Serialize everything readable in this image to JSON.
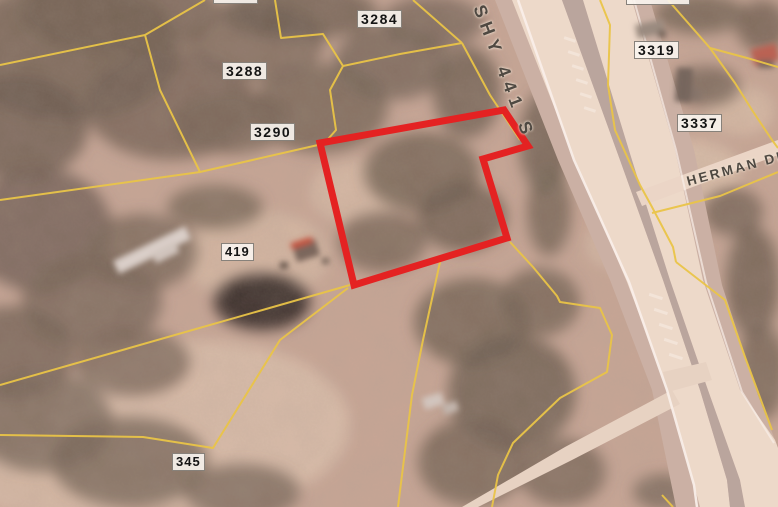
{
  "map": {
    "description": "Aerial parcel map with highlighted parcel outline",
    "parcel_labels": [
      {
        "text": "3284"
      },
      {
        "text": "3288"
      },
      {
        "text": "3290"
      },
      {
        "text": "419"
      },
      {
        "text": "345"
      },
      {
        "text": "3319"
      },
      {
        "text": "3337"
      },
      {
        "text": "3297"
      },
      {
        "text": "3286"
      }
    ],
    "road_labels": [
      {
        "text": "SHY 441 S"
      },
      {
        "text": "HERMAN DR"
      }
    ],
    "colors": {
      "highlight_outline": "#e51515",
      "parcel_line": "#eac93e",
      "road_surface": "#efe0cf",
      "road_shoulder": "#c9b3a5",
      "median": "#b6a69e",
      "label_text": "#141414",
      "road_label_text": "#4f4942",
      "terrain_base": "#c5a795",
      "tree_cover": "#665a4b"
    }
  }
}
